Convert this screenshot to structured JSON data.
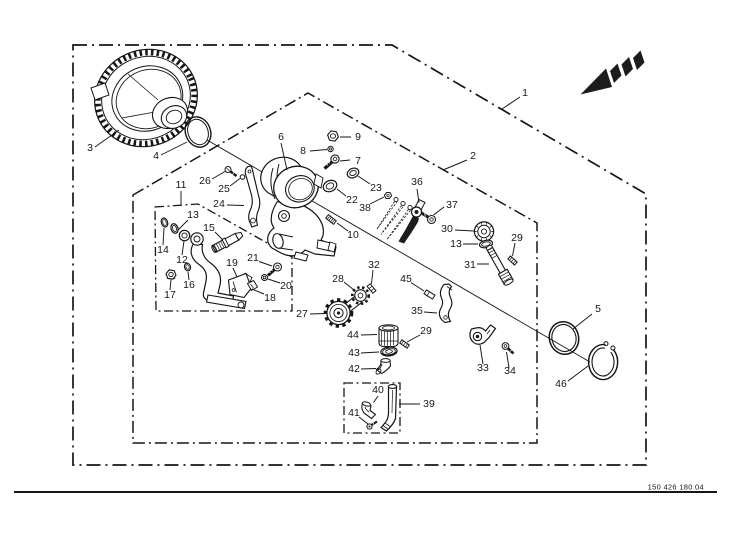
{
  "title": "exploded-parts-diagram",
  "colors": {
    "background": "#ffffff",
    "line": "#161616"
  },
  "footer": {
    "part_number": "150 426 180 04"
  },
  "icons": {
    "direction_arrow": "striped-arrow-pointing-lower-left"
  },
  "callouts": {
    "c1": "1",
    "c2": "2",
    "c3": "3",
    "c4": "4",
    "c5": "5",
    "c6": "6",
    "c7": "7",
    "c8": "8",
    "c9": "9",
    "c10": "10",
    "c11": "11",
    "c12": "12",
    "c13": "13",
    "c14": "14",
    "c15": "15",
    "c16": "16",
    "c17": "17",
    "c18": "18",
    "c19": "19",
    "c20": "20",
    "c21": "21",
    "c22": "22",
    "c23": "23",
    "c24": "24",
    "c25": "25",
    "c26": "26",
    "c27": "27",
    "c28": "28",
    "c29": "29",
    "c30": "30",
    "c31": "31",
    "c32": "32",
    "c33": "33",
    "c34": "34",
    "c35": "35",
    "c36": "36",
    "c37": "37",
    "c38": "38",
    "c39": "39",
    "c40": "40",
    "c41": "41",
    "c42": "42",
    "c43": "43",
    "c44": "44",
    "c45": "45",
    "c46": "46"
  }
}
